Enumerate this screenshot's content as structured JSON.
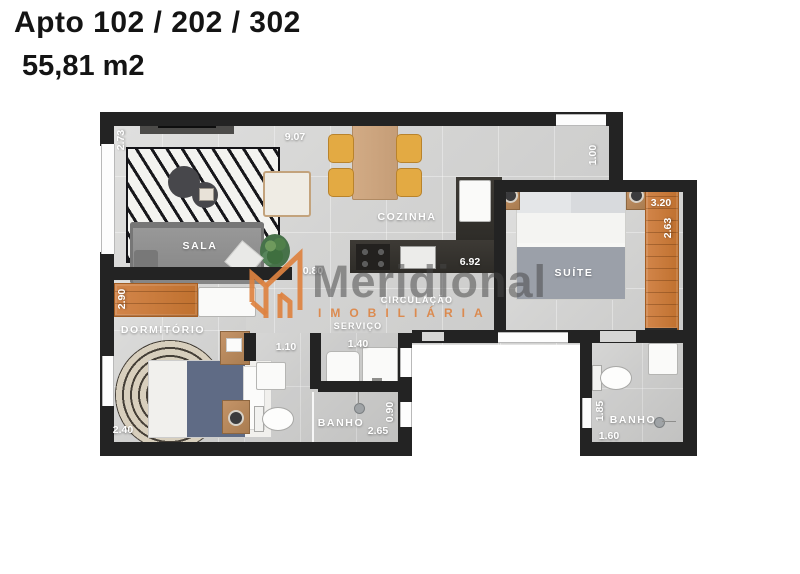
{
  "header": {
    "title": "Apto 102 / 202 / 302",
    "area": "55,81 m2"
  },
  "watermark": {
    "brand": "Meridional",
    "tagline": "IMOBILIÁRIA"
  },
  "rooms": {
    "sala": "SALA",
    "cozinha": "COZINHA",
    "suite": "SUÍTE",
    "dormitorio": "DORMITÓRIO",
    "circulacao": "CIRCULAÇÃO",
    "servico": "SERVIÇO",
    "banho_social": "BANHO",
    "banho_suite": "BANHO"
  },
  "dims": {
    "d9_07": "9.07",
    "d2_73": "2.73",
    "d1_00": "1.00",
    "d3_20": "3.20",
    "d2_63": "2.63",
    "d6_92": "6.92",
    "d0_80": "0.80",
    "d2_90": "2.90",
    "d1_10": "1.10",
    "d1_40": "1.40",
    "d2_40": "2.40",
    "d0_90": "0.90",
    "d2_65": "2.65",
    "d1_85": "1.85",
    "d1_60": "1.60"
  },
  "colors": {
    "wall": "#232323",
    "floor": "#d6d6d5",
    "furniture_orange": "#c97e43",
    "counter_dark": "#3a3732",
    "table_wood": "#c9a57f",
    "chair_yellow": "#e2a93f",
    "sofa_gray": "#8f8f8f",
    "bed_blue": "#5f6b85",
    "watermark_gray": "#4a4a4a",
    "watermark_orange": "#dd8240",
    "label_text": "#ffffff",
    "title_text": "#141414"
  }
}
